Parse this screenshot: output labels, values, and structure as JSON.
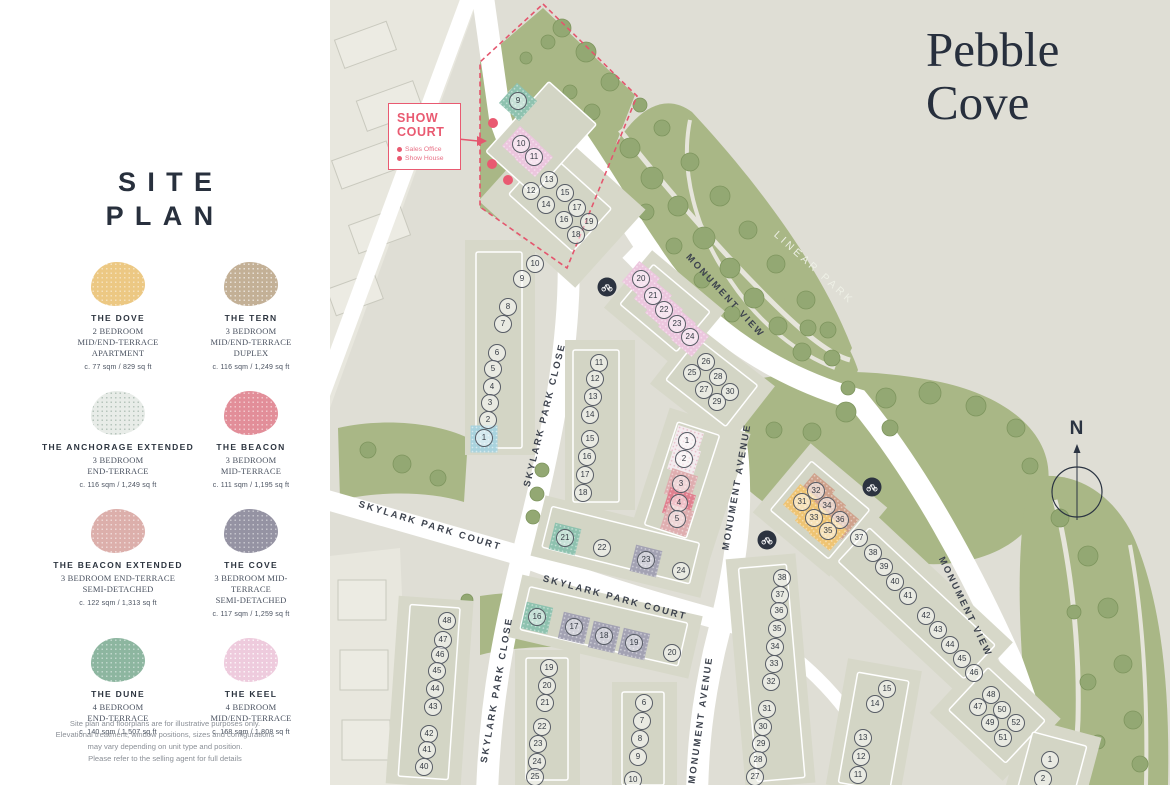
{
  "title": {
    "line1": "Pebble",
    "line2": "Cove"
  },
  "sidebar": {
    "heading": [
      "SITE",
      "PLAN"
    ],
    "legend": [
      {
        "name": "THE DOVE",
        "desc": [
          "2 BEDROOM",
          "MID/END-TERRACE",
          "APARTMENT"
        ],
        "size": "c. 77 sqm / 829 sq ft",
        "color": "#ecc883",
        "dot": "rgba(255,255,255,0.45)"
      },
      {
        "name": "THE TERN",
        "desc": [
          "3 BEDROOM",
          "MID/END-TERRACE",
          "DUPLEX"
        ],
        "size": "c. 116 sqm / 1,249 sq ft",
        "color": "#c3b096",
        "dot": "rgba(255,255,255,0.6)"
      },
      {
        "name": "THE ANCHORAGE EXTENDED",
        "desc": [
          "3 BEDROOM",
          "END-TERRACE"
        ],
        "size": "c. 116 sqm / 1,249 sq ft",
        "color": "#e8ece8",
        "dot": "rgba(140,165,150,0.55)"
      },
      {
        "name": "THE BEACON",
        "desc": [
          "3 BEDROOM",
          "MID-TERRACE"
        ],
        "size": "c. 111 sqm / 1,195 sq ft",
        "color": "#e28e99",
        "dot": "rgba(255,255,255,0.5)"
      },
      {
        "name": "THE BEACON EXTENDED",
        "desc": [
          "3 BEDROOM END-TERRACE",
          "SEMI-DETACHED"
        ],
        "size": "c. 122 sqm / 1,313 sq ft",
        "color": "#dcafab",
        "dot": "rgba(255,255,255,0.5)"
      },
      {
        "name": "THE COVE",
        "desc": [
          "3 BEDROOM MID-TERRACE",
          "SEMI-DETACHED"
        ],
        "size": "c. 117 sqm / 1,259 sq ft",
        "color": "#9593a3",
        "dot": "rgba(255,255,255,0.45)"
      },
      {
        "name": "THE DUNE",
        "desc": [
          "4 BEDROOM",
          "END-TERRACE"
        ],
        "size": "c. 140 sqm / 1,507 sq ft",
        "color": "#8db6a0",
        "dot": "rgba(255,255,255,0.45)"
      },
      {
        "name": "THE KEEL",
        "desc": [
          "4 BEDROOM",
          "MID/END-TERRACE"
        ],
        "size": "c. 168 sqm / 1,808 sq ft",
        "color": "#eecbdd",
        "dot": "rgba(255,255,255,0.75)"
      }
    ],
    "disclaimer": [
      "Site plan and floorplans are for illustrative purposes only.",
      "Elevational treatment, window positions, sizes and configurations",
      "may vary depending on unit type and position.",
      "Please refer to the selling agent for full details"
    ]
  },
  "show_court": {
    "title": [
      "SHOW",
      "COURT"
    ],
    "items": [
      "Sales Office",
      "Show House"
    ]
  },
  "north": {
    "label": "N"
  },
  "colors": {
    "accent": "#e95a71",
    "map_bg": "#dfded5",
    "park": "#a9b786",
    "title_ink": "#272f3d",
    "dove": "#efc473",
    "tern": "#cfa28c",
    "anchorage": "#f3ecef",
    "beacon": "#e0808f",
    "beacon_ext": "#dfaeb0",
    "cove": "#a3a2b3",
    "dune": "#8ec2af",
    "keel": "#ecc6de",
    "blue": "#a9d3de"
  },
  "map": {
    "streets": [
      {
        "label": "SKYLARK PARK CLOSE",
        "x": 215,
        "y": 415,
        "a": -76
      },
      {
        "label": "SKYLARK PARK CLOSE",
        "x": 167,
        "y": 690,
        "a": -80
      },
      {
        "label": "SKYLARK PARK COURT",
        "x": 100,
        "y": 526,
        "a": 17
      },
      {
        "label": "SKYLARK PARK COURT",
        "x": 285,
        "y": 598,
        "a": 15
      },
      {
        "label": "MONUMENT AVENUE",
        "x": 407,
        "y": 487,
        "a": -80
      },
      {
        "label": "MONUMENT AVENUE",
        "x": 371,
        "y": 720,
        "a": -82
      },
      {
        "label": "MONUMENT VIEW",
        "x": 395,
        "y": 296,
        "a": 47
      },
      {
        "label": "MONUMENT VIEW",
        "x": 635,
        "y": 607,
        "a": 64
      },
      {
        "label": "LINEAR PARK",
        "x": 484,
        "y": 268,
        "a": 42,
        "light": true
      }
    ],
    "plots": [
      [
        9,
        188,
        101,
        "dune",
        42
      ],
      [
        10,
        191,
        144,
        "keel",
        42
      ],
      [
        11,
        204,
        157,
        "keel",
        42
      ],
      [
        13,
        219,
        180
      ],
      [
        12,
        201,
        191
      ],
      [
        15,
        235,
        193
      ],
      [
        14,
        216,
        205
      ],
      [
        17,
        247,
        208
      ],
      [
        16,
        234,
        220
      ],
      [
        19,
        259,
        222
      ],
      [
        18,
        246,
        235
      ],
      [
        10,
        205,
        264
      ],
      [
        9,
        192,
        279
      ],
      [
        8,
        178,
        307
      ],
      [
        7,
        173,
        324
      ],
      [
        6,
        167,
        353
      ],
      [
        5,
        163,
        369
      ],
      [
        4,
        162,
        387
      ],
      [
        3,
        160,
        403
      ],
      [
        2,
        158,
        420
      ],
      [
        1,
        154,
        438,
        "blue",
        0
      ],
      [
        11,
        269,
        363
      ],
      [
        12,
        265,
        379
      ],
      [
        13,
        263,
        397
      ],
      [
        14,
        260,
        415
      ],
      [
        15,
        260,
        439
      ],
      [
        16,
        257,
        457
      ],
      [
        17,
        255,
        475
      ],
      [
        18,
        253,
        493
      ],
      [
        20,
        311,
        279,
        "keel",
        40
      ],
      [
        21,
        323,
        296,
        "keel",
        40
      ],
      [
        22,
        334,
        310,
        "keel",
        40
      ],
      [
        23,
        347,
        324,
        "keel",
        40
      ],
      [
        24,
        360,
        337,
        "keel",
        40
      ],
      [
        1,
        357,
        441,
        "anchorage",
        18
      ],
      [
        2,
        354,
        459,
        "anchorage",
        18
      ],
      [
        3,
        351,
        484,
        "beacon_ext",
        18
      ],
      [
        4,
        349,
        503,
        "beacon",
        18
      ],
      [
        5,
        347,
        519,
        "beacon_ext",
        18
      ],
      [
        26,
        376,
        362
      ],
      [
        25,
        362,
        373
      ],
      [
        28,
        388,
        377
      ],
      [
        27,
        374,
        390
      ],
      [
        30,
        400,
        392
      ],
      [
        29,
        387,
        402
      ],
      [
        21,
        235,
        538,
        "dune",
        14
      ],
      [
        22,
        272,
        548
      ],
      [
        23,
        316,
        560,
        "cove",
        14
      ],
      [
        24,
        351,
        571
      ],
      [
        16,
        207,
        617,
        "dune",
        13
      ],
      [
        17,
        244,
        627,
        "cove",
        13
      ],
      [
        18,
        274,
        636,
        "cove",
        13
      ],
      [
        19,
        304,
        643,
        "cove",
        13
      ],
      [
        20,
        342,
        653
      ],
      [
        19,
        219,
        668
      ],
      [
        20,
        217,
        686
      ],
      [
        21,
        215,
        703
      ],
      [
        22,
        212,
        727
      ],
      [
        23,
        208,
        744
      ],
      [
        24,
        207,
        762
      ],
      [
        25,
        205,
        777
      ],
      [
        48,
        117,
        621
      ],
      [
        47,
        113,
        640
      ],
      [
        46,
        110,
        655
      ],
      [
        45,
        107,
        671
      ],
      [
        44,
        105,
        689
      ],
      [
        43,
        103,
        707
      ],
      [
        42,
        99,
        734
      ],
      [
        41,
        97,
        750
      ],
      [
        40,
        94,
        767
      ],
      [
        6,
        314,
        703
      ],
      [
        7,
        312,
        721
      ],
      [
        8,
        310,
        739
      ],
      [
        9,
        308,
        757
      ],
      [
        10,
        303,
        780
      ],
      [
        38,
        452,
        578
      ],
      [
        37,
        450,
        595
      ],
      [
        36,
        449,
        611
      ],
      [
        35,
        447,
        629
      ],
      [
        34,
        445,
        647
      ],
      [
        33,
        444,
        664
      ],
      [
        32,
        441,
        682
      ],
      [
        31,
        437,
        709
      ],
      [
        30,
        433,
        727
      ],
      [
        29,
        431,
        744
      ],
      [
        28,
        428,
        760
      ],
      [
        27,
        425,
        777
      ],
      [
        32,
        486,
        491,
        "tern",
        40
      ],
      [
        31,
        472,
        502,
        "dove",
        40
      ],
      [
        34,
        497,
        506,
        "tern",
        40
      ],
      [
        33,
        484,
        518,
        "dove",
        40
      ],
      [
        36,
        510,
        520,
        "tern",
        40
      ],
      [
        35,
        498,
        531,
        "dove",
        40
      ],
      [
        37,
        529,
        538
      ],
      [
        38,
        543,
        553
      ],
      [
        39,
        554,
        567
      ],
      [
        40,
        565,
        582
      ],
      [
        41,
        578,
        596
      ],
      [
        42,
        596,
        616
      ],
      [
        43,
        608,
        630
      ],
      [
        44,
        620,
        645
      ],
      [
        45,
        632,
        659
      ],
      [
        46,
        644,
        673
      ],
      [
        48,
        661,
        695
      ],
      [
        47,
        648,
        707
      ],
      [
        50,
        672,
        710
      ],
      [
        49,
        660,
        723
      ],
      [
        52,
        686,
        723
      ],
      [
        51,
        673,
        738
      ],
      [
        15,
        557,
        689
      ],
      [
        14,
        545,
        704
      ],
      [
        13,
        533,
        738
      ],
      [
        12,
        531,
        757
      ],
      [
        11,
        528,
        775
      ],
      [
        1,
        720,
        760
      ],
      [
        2,
        713,
        779
      ]
    ],
    "bike_markers": [
      {
        "x": 277,
        "y": 287
      },
      {
        "x": 542,
        "y": 487
      },
      {
        "x": 437,
        "y": 540
      }
    ],
    "poi_dots": [
      {
        "x": 163,
        "y": 123
      },
      {
        "x": 162,
        "y": 164
      },
      {
        "x": 178,
        "y": 180
      }
    ]
  }
}
